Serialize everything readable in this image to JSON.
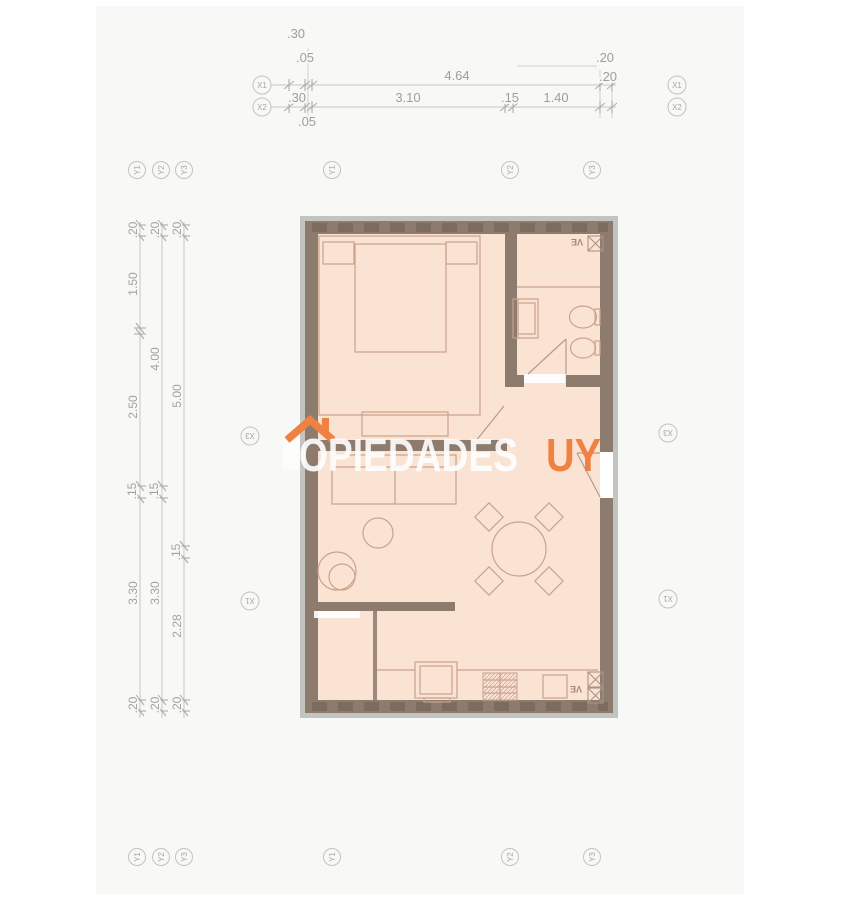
{
  "watermark": {
    "brand_text_partial": "OPIEDADES",
    "brand_suffix": "UY",
    "icon": "house-roof-icon"
  },
  "colors": {
    "wall": "#8d7b6e",
    "wall_dash": "#6d5e53",
    "wall_edge_gray": "#a5a8a1",
    "floor": "#fbe3d4",
    "furniture_line": "#c9a28c",
    "dimension_line": "#c6c6c6",
    "dimension_text": "#9e9e9e",
    "brand_orange": "#ef8142",
    "watermark_white": "#ffffff",
    "page_background": "#f8f8f6"
  },
  "top_dims": {
    "offset_30": ".30",
    "offset_05_above": ".05",
    "offset_20_above": ".20",
    "x1_total": "4.64",
    "x1_end": ".20",
    "x2_start": ".30",
    "x2_span": "3.10",
    "x2_mid": ".15",
    "x2_end": "1.40",
    "offset_05_below": ".05"
  },
  "left_dims": {
    "l1_top": ".20",
    "l1_upper": "1.50",
    "l1_mid": "2.50",
    "l1_step": ".15",
    "l1_lower": "3.30",
    "l1_bottom": ".20",
    "l2_top": ".20",
    "l2_upper": "4.00",
    "l2_step": ".15",
    "l2_lower": "3.30",
    "l2_bottom": ".20",
    "l3_top": ".20",
    "l3_upper": "5.00",
    "l3_step": ".15",
    "l3_lower": "2.28",
    "l3_bottom": ".20"
  },
  "grid_axes": {
    "x1": "X1",
    "x2": "X2",
    "x3": "X3",
    "y1": "Y1",
    "y2": "Y2",
    "y3": "Y3"
  },
  "room_labels": {
    "vent_bath": "VE",
    "vent_kitchen": "VE"
  }
}
